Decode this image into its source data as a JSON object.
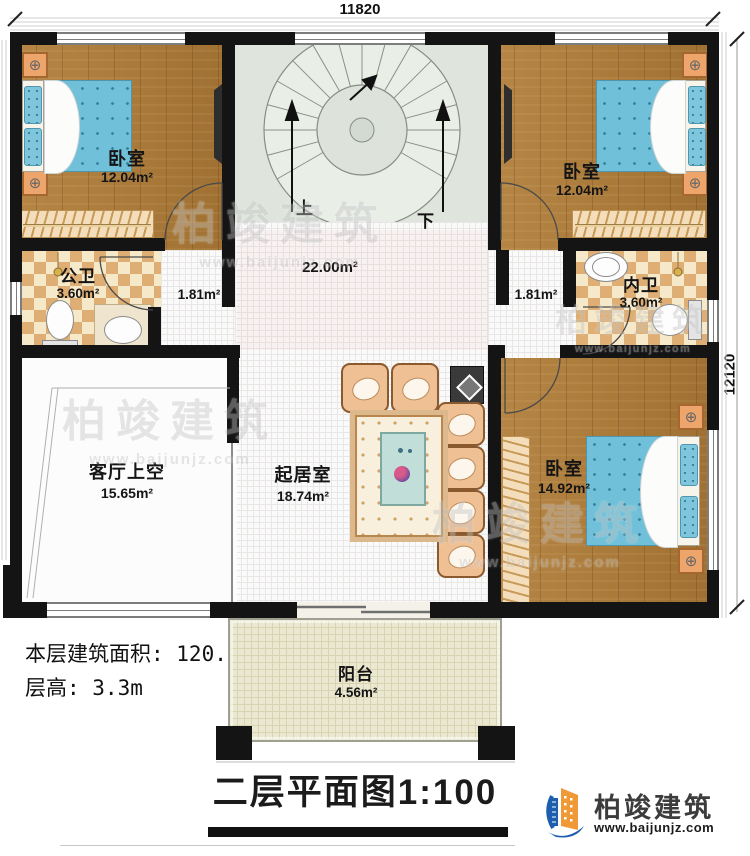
{
  "plan": {
    "dim_top": "11820",
    "dim_right": "12120",
    "rooms": {
      "bedroom_tl": {
        "name": "卧室",
        "area": "12.04m²"
      },
      "bedroom_tr": {
        "name": "卧室",
        "area": "12.04m²"
      },
      "bedroom_br": {
        "name": "卧室",
        "area": "14.92m²"
      },
      "bath_left": {
        "name": "公卫",
        "area": "3.60m²"
      },
      "bath_right": {
        "name": "内卫",
        "area": "3.60m²"
      },
      "hall": {
        "area": "22.00m²"
      },
      "corridor_left": {
        "area": "1.81m²"
      },
      "corridor_right": {
        "area": "1.81m²"
      },
      "living_void": {
        "name": "客厅上空",
        "area": "15.65m²"
      },
      "family": {
        "name": "起居室",
        "area": "18.74m²"
      },
      "balcony": {
        "name": "阳台",
        "area": "4.56m²"
      }
    },
    "stairs": {
      "up": "上",
      "down": "下"
    }
  },
  "info": {
    "floor_area": "本层建筑面积: 120.00m²",
    "floor_height": "层高: 3.3m"
  },
  "title": {
    "text": "二层平面图",
    "scale": "1:100"
  },
  "brand": {
    "name": "柏竣建筑",
    "url": "www.baijunjz.com"
  },
  "watermark": {
    "name": "柏竣建筑",
    "url": "www.baijunjz.com"
  },
  "icons": {
    "lamp_dial": "⊕"
  },
  "colors": {
    "wall": "#141414",
    "wood": "#b07c36",
    "tile": "#dfae74",
    "bed": "#6fc0d8",
    "stair_room": "#dfe5dd",
    "balcony": "#ebe8d2",
    "logo_blue": "#1d5fae",
    "logo_orange": "#f09a37"
  }
}
